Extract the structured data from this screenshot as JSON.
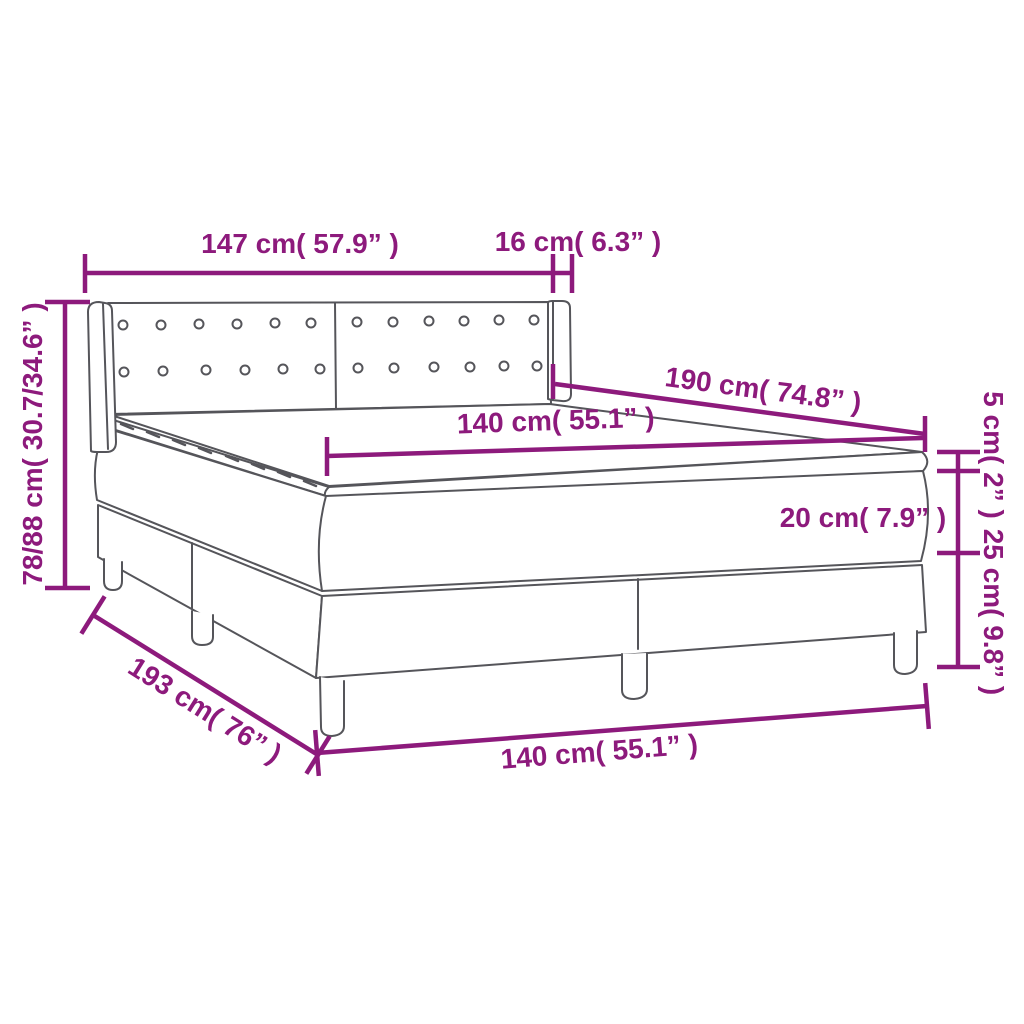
{
  "diagram": {
    "title": "box-spring-bed-dimension-diagram",
    "product": "Box spring bed with headboard, mattress and topper",
    "colors": {
      "dimension_accent": "#8d1a7c",
      "line_art": "#55555a",
      "background": "#ffffff"
    },
    "labels": {
      "headboard_width": "147 cm( 57.9” )",
      "side_wing_depth": "16 cm( 6.3” )",
      "bed_length": "190 cm( 74.8” )",
      "mattress_width_top": "140 cm( 55.1” )",
      "headboard_height": "78/88 cm( 30.7/34.6” )",
      "topper_thickness": "5 cm( 2” )",
      "mattress_thickness": "20 cm( 7.9” )",
      "base_height": "25 cm( 9.8” )",
      "base_length": "193 cm( 76” )",
      "base_width_bottom": "140 cm( 55.1” )"
    }
  }
}
